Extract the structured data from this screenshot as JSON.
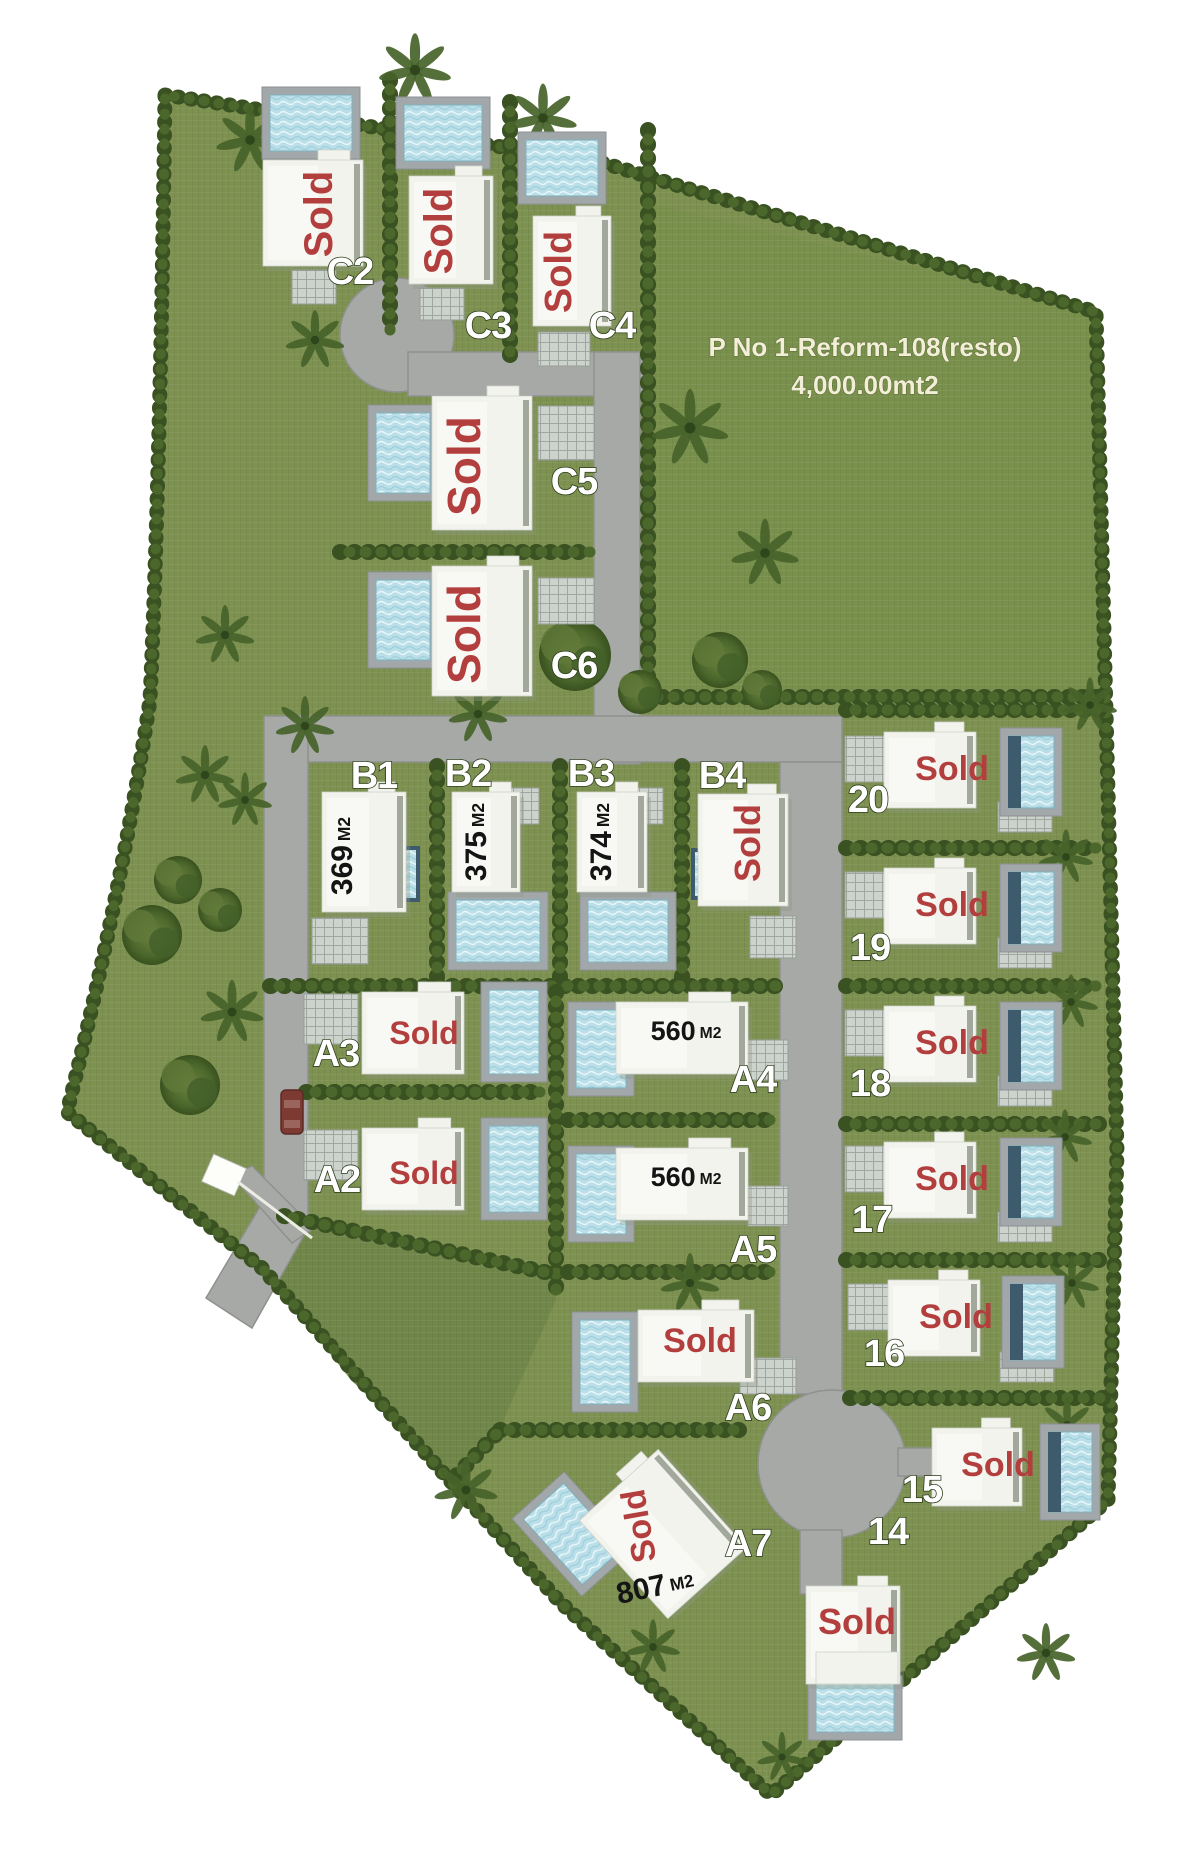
{
  "map": {
    "sold_label": "Sold",
    "unit_suffix": "M2",
    "field": {
      "title_line1": "P No 1-Reform-108(resto)",
      "title_line2": "4,000.00mt2"
    },
    "plots": [
      {
        "id": "C2",
        "label": "C2",
        "status": "sold"
      },
      {
        "id": "C3",
        "label": "C3",
        "status": "sold"
      },
      {
        "id": "C4",
        "label": "C4",
        "status": "sold"
      },
      {
        "id": "C5",
        "label": "C5",
        "status": "sold"
      },
      {
        "id": "C6",
        "label": "C6",
        "status": "sold"
      },
      {
        "id": "B1",
        "label": "B1",
        "size": "369"
      },
      {
        "id": "B2",
        "label": "B2",
        "size": "375"
      },
      {
        "id": "B3",
        "label": "B3",
        "size": "374"
      },
      {
        "id": "B4",
        "label": "B4",
        "status": "sold"
      },
      {
        "id": "20",
        "label": "20",
        "status": "sold"
      },
      {
        "id": "19",
        "label": "19",
        "status": "sold"
      },
      {
        "id": "18",
        "label": "18",
        "status": "sold"
      },
      {
        "id": "17",
        "label": "17",
        "status": "sold"
      },
      {
        "id": "16",
        "label": "16",
        "status": "sold"
      },
      {
        "id": "15",
        "label": "15",
        "status": "sold"
      },
      {
        "id": "14",
        "label": "14",
        "status": "sold"
      },
      {
        "id": "A3",
        "label": "A3",
        "status": "sold"
      },
      {
        "id": "A2",
        "label": "A2",
        "status": "sold"
      },
      {
        "id": "A4",
        "label": "A4",
        "size": "560"
      },
      {
        "id": "A5",
        "label": "A5",
        "size": "560"
      },
      {
        "id": "A6",
        "label": "A6",
        "status": "sold"
      },
      {
        "id": "A7",
        "label": "A7",
        "status": "sold",
        "size": "807"
      }
    ],
    "colors": {
      "grass": "#7d9150",
      "field_grass": "#78904c",
      "reserve_grass": "#71874a",
      "hedge": "#3a5222",
      "road": "#a7a9a6",
      "pool_water": "#badfe8",
      "pool_deck": "#a2a7aa",
      "villa": "#f3f3ee",
      "sold_red": "#b23f3d",
      "size_text": "#141414",
      "car": "#7d3a33"
    }
  }
}
